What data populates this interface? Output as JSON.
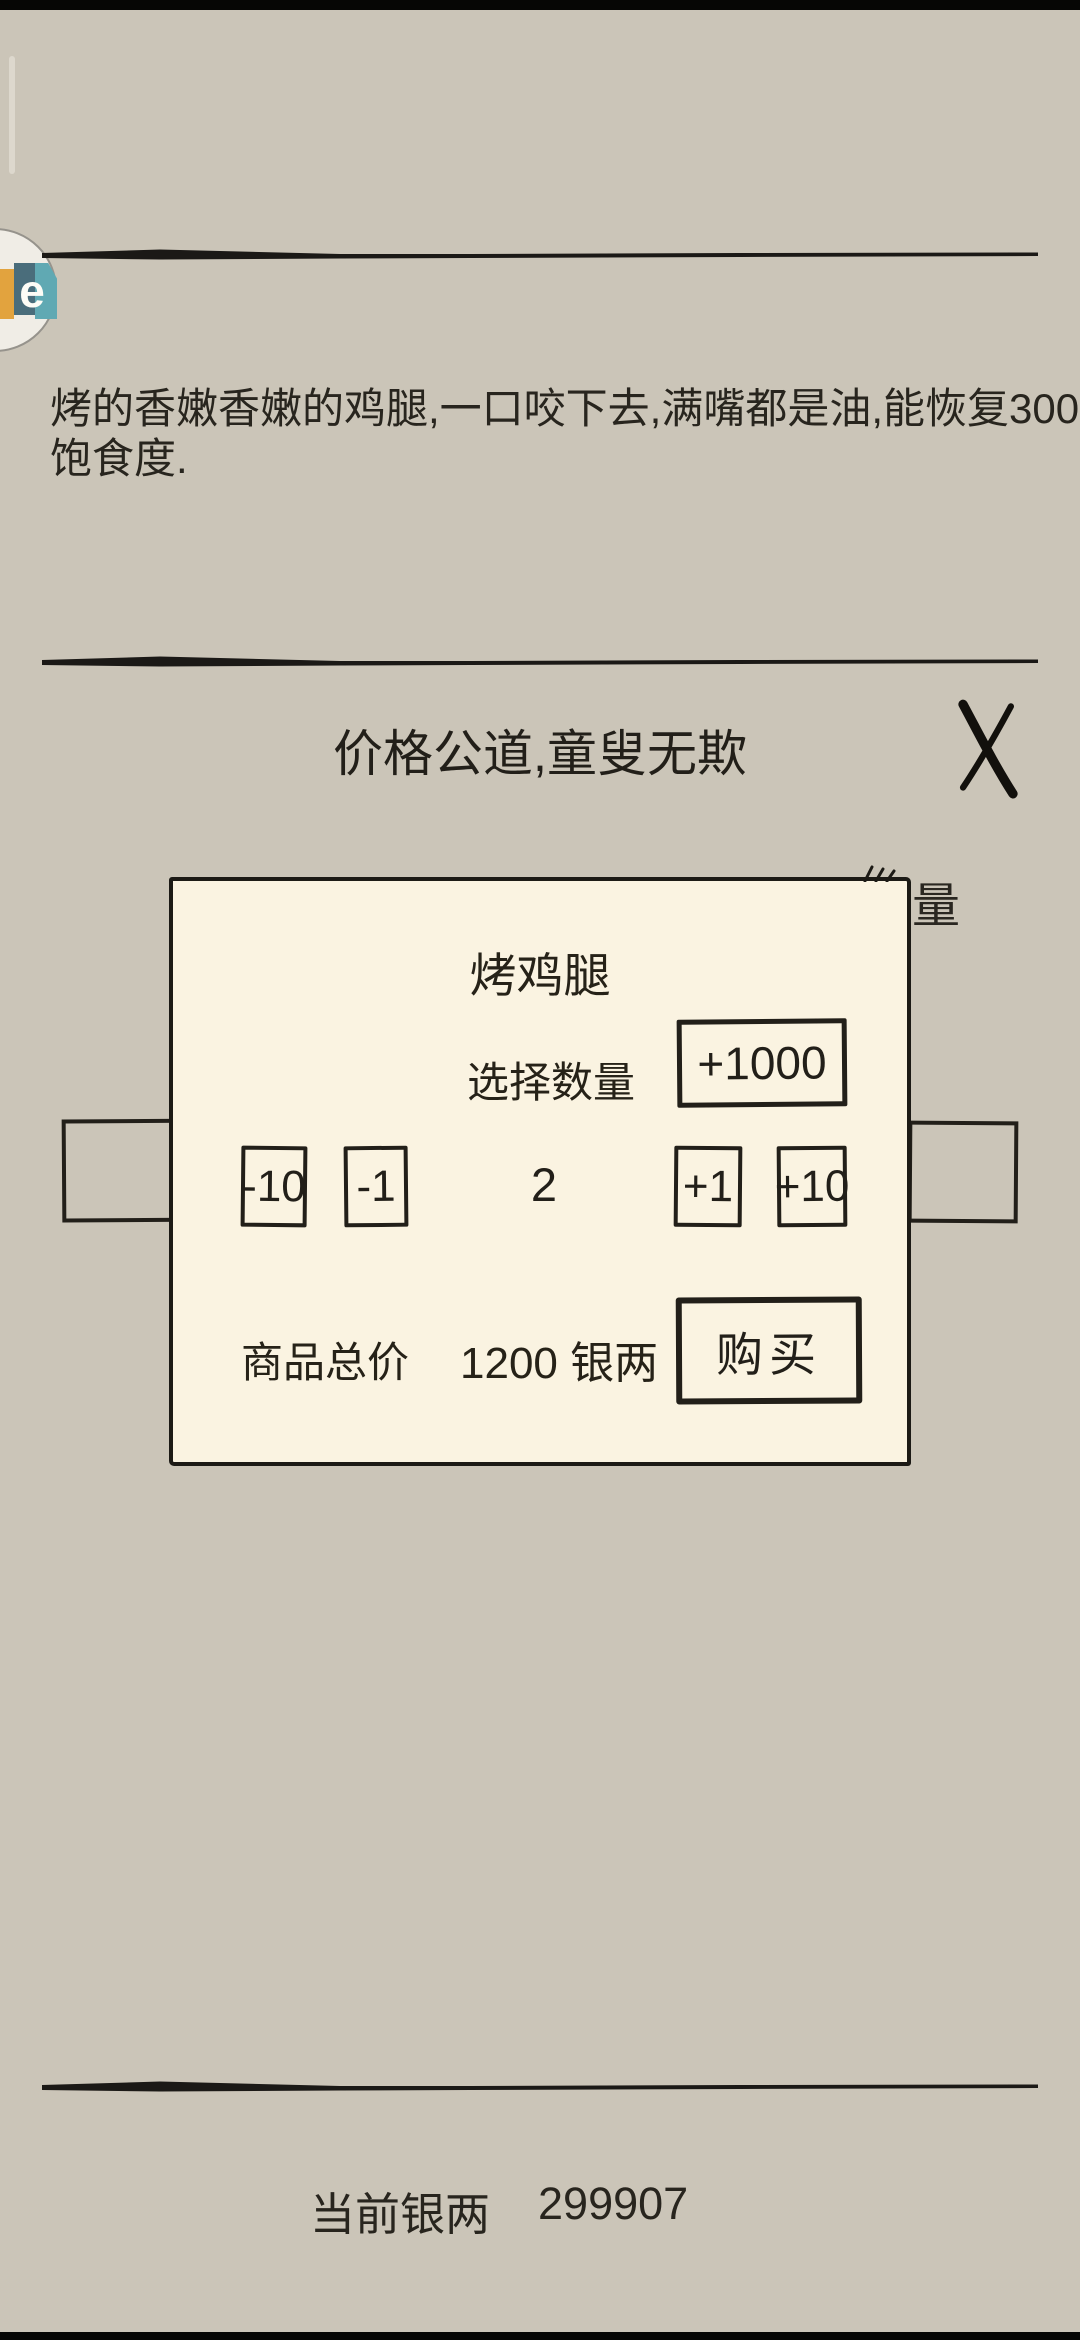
{
  "colors": {
    "background": "#cbc5b8",
    "dialog_bg": "#faf3e1",
    "ink": "#23201a",
    "badge_orange": "#e2a33e",
    "badge_slate": "#4a6d7b",
    "badge_teal": "#60a9b3"
  },
  "overlay_badge": {
    "letter": "e"
  },
  "item_detail": {
    "description_line1": "烤的香嫩香嫩的鸡腿,一口咬下去,满嘴都是油,能恢复300点",
    "description_line2": "饱食度."
  },
  "shop": {
    "motto": "价格公道,童叟无欺",
    "columns": {
      "quantity": "数量",
      "price": "价格",
      "owned": "拥有数量"
    }
  },
  "dialog": {
    "title": "烤鸡腿",
    "quantity_label": "选择数量",
    "quantity_value": "2",
    "buttons": {
      "plus1000": "+1000",
      "minus10": "-10",
      "minus1": "-1",
      "plus1": "+1",
      "plus10": "+10",
      "buy": "购买"
    },
    "total_label": "商品总价",
    "total_value": "1200 银两"
  },
  "footer": {
    "silver_label": "当前银两",
    "silver_value": "299907"
  }
}
